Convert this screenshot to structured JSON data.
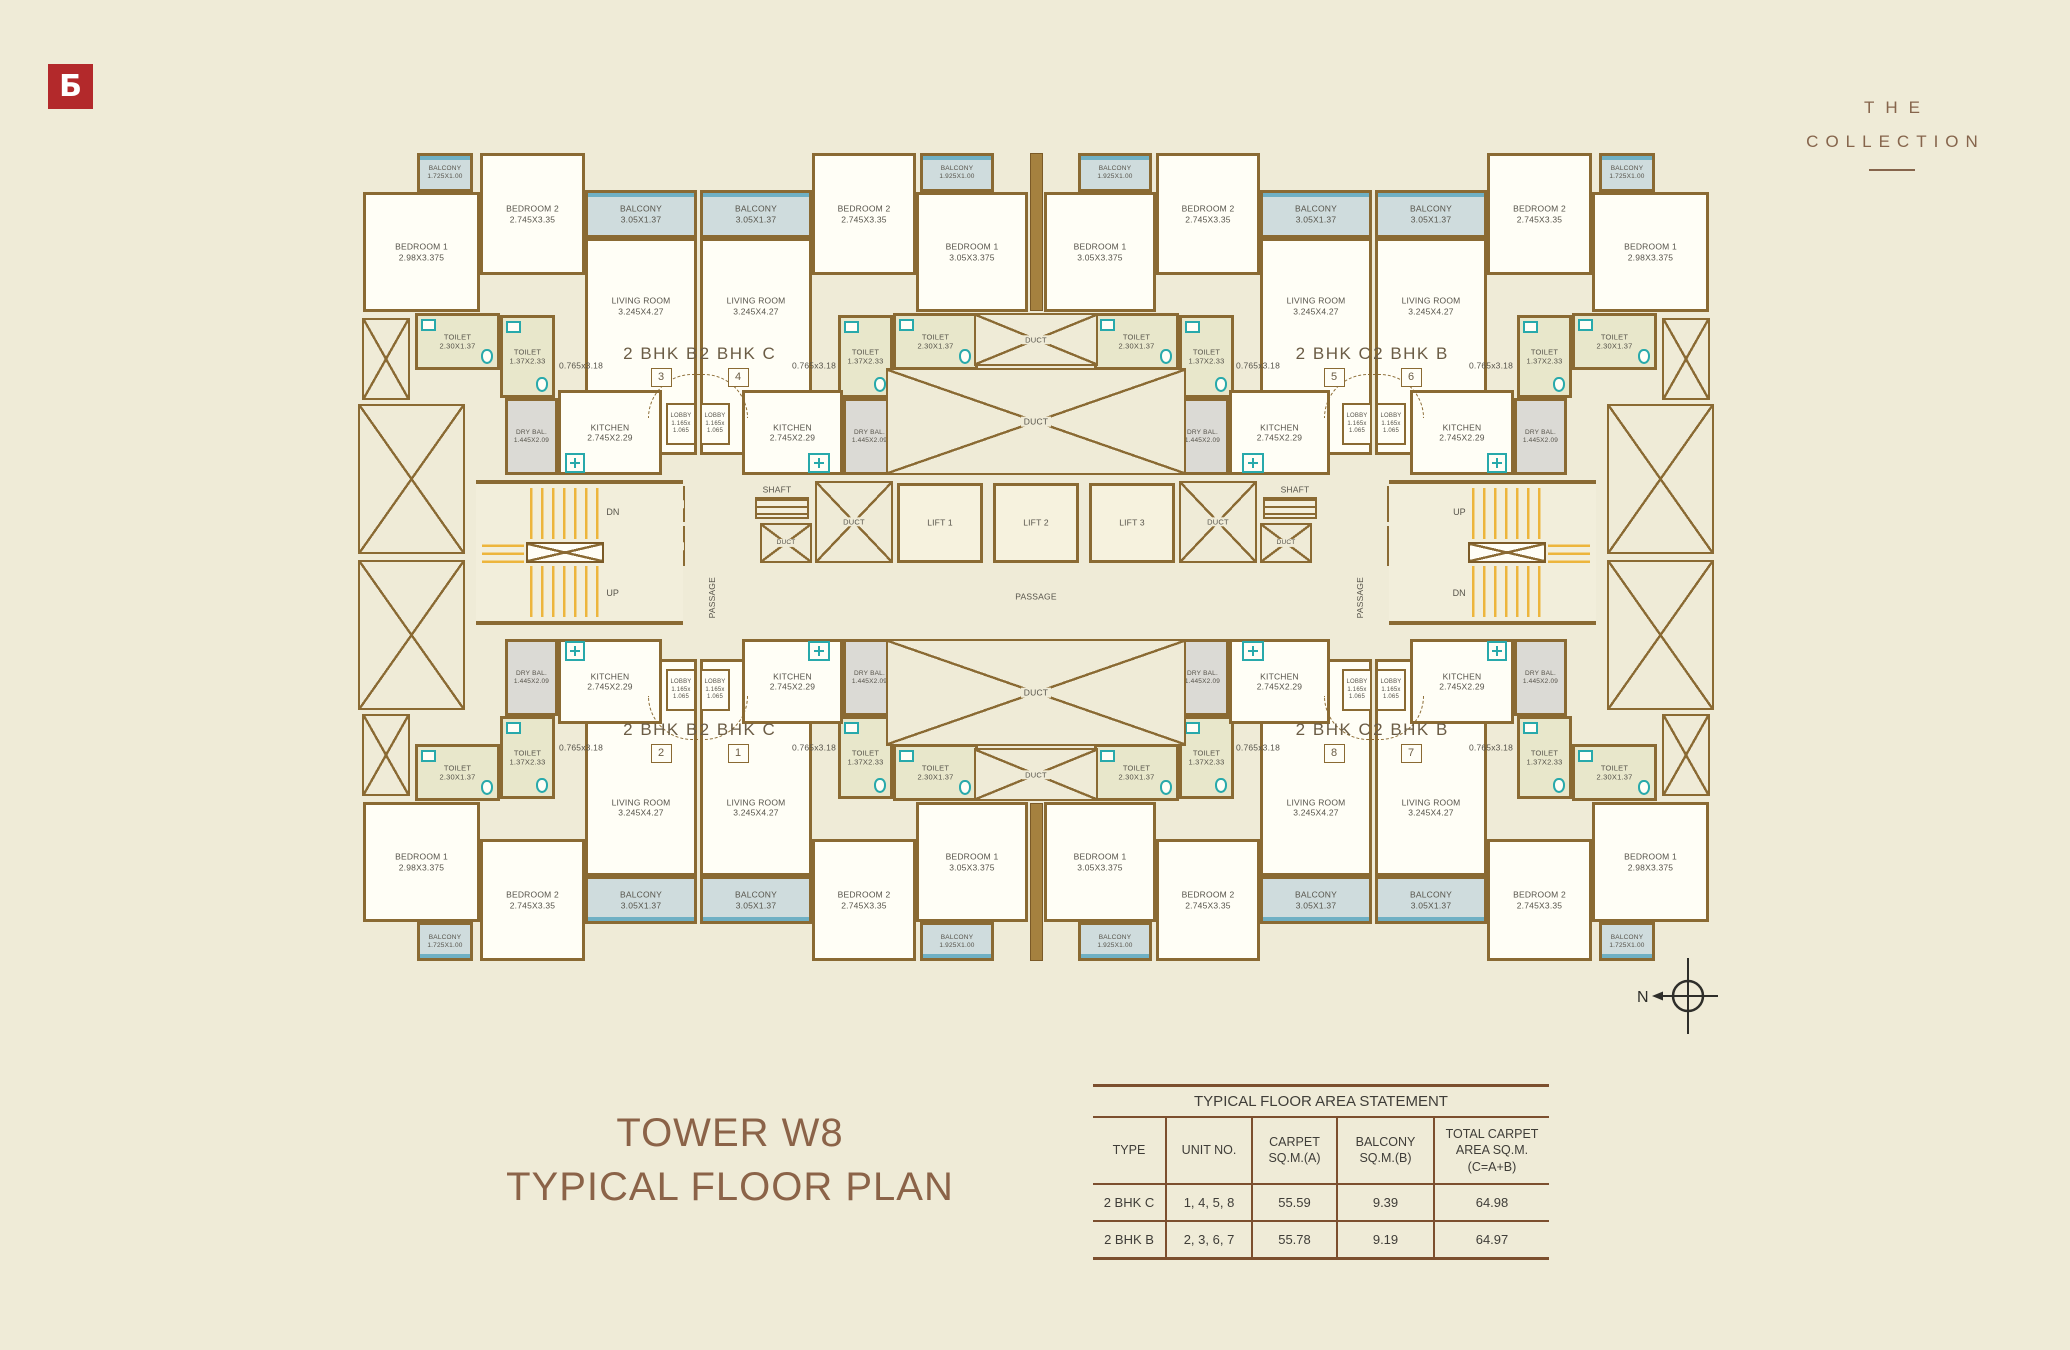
{
  "brand": {
    "logo_letter": "Ƃ",
    "wordmark_line1": "THE",
    "wordmark_line2": "COLLECTION"
  },
  "title": {
    "line1": "TOWER W8",
    "line2": "TYPICAL FLOOR PLAN"
  },
  "compass": {
    "label": "N"
  },
  "area_table": {
    "title": "TYPICAL FLOOR AREA STATEMENT",
    "headers": [
      "TYPE",
      "UNIT NO.",
      "CARPET\nSQ.M.(A)",
      "BALCONY\nSQ.M.(B)",
      "TOTAL CARPET\nAREA SQ.M.\n(C=A+B)"
    ],
    "rows": [
      [
        "2 BHK C",
        "1, 4, 5, 8",
        "55.59",
        "9.39",
        "64.98"
      ],
      [
        "2 BHK B",
        "2, 3, 6, 7",
        "55.78",
        "9.19",
        "64.97"
      ]
    ]
  },
  "colors": {
    "background": "#efebd7",
    "wall": "#8a6a33",
    "room_floor": "#fffef6",
    "balcony_floor": "#cfdcdd",
    "toilet_floor": "#e8e7cb",
    "dry_balcony_floor": "#dbdad5",
    "stair_yellow": "#edb53c",
    "fixture_teal": "#28a9ab",
    "window_blue": "#6fb0c4",
    "logo_red": "#b3292b",
    "title_brown": "#8b6348",
    "table_line_brown": "#7c4f2e",
    "label_gray": "#56534a"
  },
  "plan": {
    "mirror_cx": 2072,
    "mirror_cy": 1114,
    "rooms": [
      {
        "id": "void-box-narrow",
        "t": "duct",
        "x": 362,
        "y": 318,
        "w": 48,
        "h": 82,
        "l": [],
        "c": [
          "tl",
          "tr",
          "bl",
          "br"
        ]
      },
      {
        "id": "void-box-wide",
        "t": "duct",
        "x": 358,
        "y": 404,
        "w": 107,
        "h": 150,
        "l": [],
        "c": [
          "tl",
          "tr",
          "bl",
          "br"
        ]
      },
      {
        "id": "bedroom1-corner",
        "t": "room",
        "x": 363,
        "y": 192,
        "w": 117,
        "h": 120,
        "l": [
          "BEDROOM 1",
          "2.98X3.375"
        ],
        "c": [
          "tl",
          "tr",
          "bl",
          "br"
        ]
      },
      {
        "id": "balcony-corner",
        "t": "balcony",
        "x": 417,
        "y": 153,
        "w": 56,
        "h": 39,
        "l": [
          "BALCONY",
          "1.725X1.00"
        ],
        "c": [
          "tl",
          "tr",
          "bl",
          "br"
        ],
        "fs": 6.5
      },
      {
        "id": "bedroom2-outer",
        "t": "room",
        "x": 480,
        "y": 153,
        "w": 105,
        "h": 122,
        "l": [
          "BEDROOM 2",
          "2.745X3.35"
        ],
        "c": [
          "tl",
          "tr",
          "bl",
          "br"
        ]
      },
      {
        "id": "living-room-outer",
        "t": "room",
        "x": 585,
        "y": 238,
        "w": 112,
        "h": 217,
        "l": [
          "LIVING ROOM",
          "3.245X4.27"
        ],
        "c": [
          "tl",
          "tr",
          "bl",
          "br"
        ],
        "lp": 31
      },
      {
        "id": "living-room-inner",
        "t": "room",
        "x": 700,
        "y": 238,
        "w": 112,
        "h": 217,
        "l": [
          "LIVING ROOM",
          "3.245X4.27"
        ],
        "c": [
          "tl",
          "tr",
          "bl",
          "br"
        ],
        "lp": 31
      },
      {
        "id": "balcony-outer",
        "t": "balcony",
        "x": 585,
        "y": 190,
        "w": 112,
        "h": 48,
        "l": [
          "BALCONY",
          "3.05X1.37"
        ],
        "c": [
          "tl",
          "tr",
          "bl",
          "br"
        ]
      },
      {
        "id": "balcony-inner",
        "t": "balcony",
        "x": 700,
        "y": 190,
        "w": 112,
        "h": 48,
        "l": [
          "BALCONY",
          "3.05X1.37"
        ],
        "c": [
          "tl",
          "tr",
          "bl",
          "br"
        ]
      },
      {
        "id": "bedroom2-inner",
        "t": "room",
        "x": 812,
        "y": 153,
        "w": 104,
        "h": 122,
        "l": [
          "BEDROOM 2",
          "2.745X3.35"
        ],
        "c": [
          "tl",
          "tr",
          "bl",
          "br"
        ]
      },
      {
        "id": "balcony-center",
        "t": "balcony",
        "x": 920,
        "y": 153,
        "w": 74,
        "h": 39,
        "l": [
          "BALCONY",
          "1.925X1.00"
        ],
        "c": [
          "tl",
          "tr",
          "bl",
          "br"
        ],
        "fs": 6.5
      },
      {
        "id": "bedroom1-center",
        "t": "room",
        "x": 916,
        "y": 192,
        "w": 112,
        "h": 120,
        "l": [
          "BEDROOM 1",
          "3.05X3.375"
        ],
        "c": [
          "tl",
          "tr",
          "bl",
          "br"
        ]
      },
      {
        "id": "center-wall-column",
        "t": "wall",
        "x": 1030,
        "y": 153,
        "w": 13,
        "h": 158,
        "l": [],
        "c": [
          "tl",
          "bl"
        ]
      },
      {
        "id": "toilet-wide-outer",
        "t": "toilet",
        "x": 415,
        "y": 313,
        "w": 85,
        "h": 57,
        "l": [
          "TOILET",
          "2.30X1.37"
        ],
        "c": [
          "tl",
          "tr",
          "bl",
          "br"
        ],
        "fs": 7.5
      },
      {
        "id": "toilet-tall-outer",
        "t": "toilet",
        "x": 500,
        "y": 315,
        "w": 55,
        "h": 83,
        "l": [
          "TOILET",
          "1.37X2.33"
        ],
        "c": [
          "tl",
          "tr",
          "bl",
          "br"
        ],
        "fs": 7.5
      },
      {
        "id": "toilet-tall-inner",
        "t": "toilet",
        "x": 838,
        "y": 315,
        "w": 55,
        "h": 83,
        "l": [
          "TOILET",
          "1.37X2.33"
        ],
        "c": [
          "tl",
          "tr",
          "bl",
          "br"
        ],
        "fs": 7.5
      },
      {
        "id": "toilet-wide-inner",
        "t": "toilet",
        "x": 893,
        "y": 313,
        "w": 85,
        "h": 57,
        "l": [
          "TOILET",
          "2.30X1.37"
        ],
        "c": [
          "tl",
          "tr",
          "bl",
          "br"
        ],
        "fs": 7.5
      },
      {
        "id": "kitchen-outer",
        "t": "room",
        "x": 558,
        "y": 390,
        "w": 104,
        "h": 85,
        "l": [
          "KITCHEN",
          "2.745X2.29"
        ],
        "c": [
          "tl",
          "tr",
          "bl",
          "br"
        ]
      },
      {
        "id": "kitchen-inner",
        "t": "room",
        "x": 742,
        "y": 390,
        "w": 101,
        "h": 85,
        "l": [
          "KITCHEN",
          "2.745X2.29"
        ],
        "c": [
          "tl",
          "tr",
          "bl",
          "br"
        ]
      },
      {
        "id": "dry-balcony-outer",
        "t": "drybal",
        "x": 505,
        "y": 398,
        "w": 53,
        "h": 77,
        "l": [
          "DRY BAL.",
          "1.445X2.09"
        ],
        "c": [
          "tl",
          "tr",
          "bl",
          "br"
        ],
        "fs": 6.5
      },
      {
        "id": "dry-balcony-inner",
        "t": "drybal",
        "x": 843,
        "y": 398,
        "w": 53,
        "h": 77,
        "l": [
          "DRY BAL.",
          "1.445X2.09"
        ],
        "c": [
          "tl",
          "tr",
          "bl",
          "br"
        ],
        "fs": 6.5
      },
      {
        "id": "entry-arc",
        "t": "arc",
        "x": 648,
        "y": 374,
        "w": 100,
        "h": 44,
        "l": [],
        "c": [
          "tl",
          "tr",
          "bl",
          "br"
        ]
      },
      {
        "id": "lobby-outer",
        "t": "lobby",
        "x": 666,
        "y": 403,
        "w": 30,
        "h": 42,
        "l": [
          "LOBBY",
          "1.165x",
          "1.065"
        ],
        "c": [
          "tl",
          "tr",
          "bl",
          "br"
        ],
        "fs": 6
      },
      {
        "id": "lobby-inner",
        "t": "lobby",
        "x": 700,
        "y": 403,
        "w": 30,
        "h": 42,
        "l": [
          "LOBBY",
          "1.165x",
          "1.065"
        ],
        "c": [
          "tl",
          "tr",
          "bl",
          "br"
        ],
        "fs": 6
      },
      {
        "id": "passage-dim-outer",
        "t": "label",
        "x": 551,
        "y": 360,
        "w": 60,
        "h": 12,
        "l": [
          "0.765x3.18"
        ],
        "c": [
          "tl",
          "tr",
          "bl",
          "br"
        ]
      },
      {
        "id": "passage-dim-inner",
        "t": "label",
        "x": 784,
        "y": 360,
        "w": 60,
        "h": 12,
        "l": [
          "0.765x3.18"
        ],
        "c": [
          "tl",
          "tr",
          "bl",
          "br"
        ]
      },
      {
        "id": "wash-point-outer",
        "t": "plus",
        "x": 565,
        "y": 453,
        "w": 20,
        "h": 20,
        "l": [],
        "c": [
          "tl",
          "tr",
          "bl",
          "br"
        ]
      },
      {
        "id": "wash-point-inner",
        "t": "plus",
        "x": 808,
        "y": 453,
        "w": 22,
        "h": 20,
        "l": [],
        "c": [
          "tl",
          "tr",
          "bl",
          "br"
        ]
      },
      {
        "id": "duct-main",
        "t": "duct",
        "x": 886,
        "y": 368,
        "w": 300,
        "h": 107,
        "l": [
          "DUCT"
        ],
        "c": [
          "tl",
          "bl"
        ]
      },
      {
        "id": "duct-mid",
        "t": "duct",
        "x": 974,
        "y": 313,
        "w": 124,
        "h": 53,
        "l": [
          "DUCT"
        ],
        "c": [
          "tl",
          "bl"
        ],
        "fs": 7.5
      },
      {
        "id": "shaft-label",
        "t": "label",
        "x": 755,
        "y": 484,
        "w": 44,
        "h": 11,
        "l": [
          "SHAFT"
        ],
        "c": [
          "tl",
          "tr"
        ]
      },
      {
        "id": "shaft-grill",
        "t": "grill",
        "x": 755,
        "y": 497,
        "w": 54,
        "h": 22,
        "l": [],
        "c": [
          "tl",
          "tr"
        ]
      },
      {
        "id": "shaft-duct-small",
        "t": "duct",
        "x": 760,
        "y": 523,
        "w": 52,
        "h": 40,
        "l": [
          "DUCT"
        ],
        "c": [
          "tl",
          "tr"
        ],
        "fs": 6.5
      },
      {
        "id": "duct-side",
        "t": "duct",
        "x": 815,
        "y": 481,
        "w": 78,
        "h": 82,
        "l": [
          "DUCT"
        ],
        "c": [
          "tl",
          "tr"
        ],
        "fs": 7.5
      },
      {
        "id": "shaft-box-a",
        "t": "duct",
        "x": 653,
        "y": 486,
        "w": 32,
        "h": 36,
        "l": [
          "SHAFT"
        ],
        "c": [
          "tl",
          "tr"
        ],
        "fs": 6
      },
      {
        "id": "shaft-box-b",
        "t": "duct",
        "x": 653,
        "y": 526,
        "w": 32,
        "h": 40,
        "l": [
          "SHAFT"
        ],
        "c": [
          "tl",
          "tr"
        ],
        "fs": 6
      },
      {
        "id": "lift-1",
        "t": "lift",
        "x": 897,
        "y": 483,
        "w": 86,
        "h": 80,
        "l": [
          "LIFT 1"
        ],
        "c": [
          "tl"
        ]
      },
      {
        "id": "lift-2",
        "t": "lift",
        "x": 993,
        "y": 483,
        "w": 86,
        "h": 80,
        "l": [
          "LIFT 2"
        ],
        "c": [
          "tl"
        ]
      },
      {
        "id": "lift-3",
        "t": "lift",
        "x": 1089,
        "y": 483,
        "w": 86,
        "h": 80,
        "l": [
          "LIFT 3"
        ],
        "c": [
          "tl"
        ]
      },
      {
        "id": "passage-center-label",
        "t": "label",
        "x": 992,
        "y": 590,
        "w": 88,
        "h": 14,
        "l": [
          "PASSAGE"
        ],
        "c": [
          "tl"
        ]
      },
      {
        "id": "passage-side-label",
        "t": "vlabel",
        "x": 704,
        "y": 570,
        "w": 16,
        "h": 56,
        "l": [
          "PASSAGE"
        ],
        "c": [
          "tl",
          "tr"
        ]
      },
      {
        "id": "staircase-left",
        "t": "stair",
        "x": 476,
        "y": 480,
        "w": 207,
        "h": 145,
        "l": [
          "DN",
          "UP"
        ],
        "c": [
          "tl"
        ]
      },
      {
        "id": "staircase-right",
        "t": "stair",
        "x": 1389,
        "y": 480,
        "w": 207,
        "h": 145,
        "l": [
          "UP",
          "DN"
        ],
        "c": [
          "tl"
        ]
      }
    ],
    "units": [
      {
        "id": "unit-3",
        "bhk": "2 BHK B",
        "num": "3",
        "cx": 661,
        "y": 344
      },
      {
        "id": "unit-4",
        "bhk": "2 BHK C",
        "num": "4",
        "cx": 738,
        "y": 344
      },
      {
        "id": "unit-5",
        "bhk": "2 BHK C",
        "num": "5",
        "cx": 1334,
        "y": 344
      },
      {
        "id": "unit-6",
        "bhk": "2 BHK B",
        "num": "6",
        "cx": 1411,
        "y": 344
      },
      {
        "id": "unit-2",
        "bhk": "2 BHK B",
        "num": "2",
        "cx": 661,
        "y": 720
      },
      {
        "id": "unit-1",
        "bhk": "2 BHK C",
        "num": "1",
        "cx": 738,
        "y": 720
      },
      {
        "id": "unit-8",
        "bhk": "2 BHK C",
        "num": "8",
        "cx": 1334,
        "y": 720
      },
      {
        "id": "unit-7",
        "bhk": "2 BHK B",
        "num": "7",
        "cx": 1411,
        "y": 720
      }
    ]
  }
}
